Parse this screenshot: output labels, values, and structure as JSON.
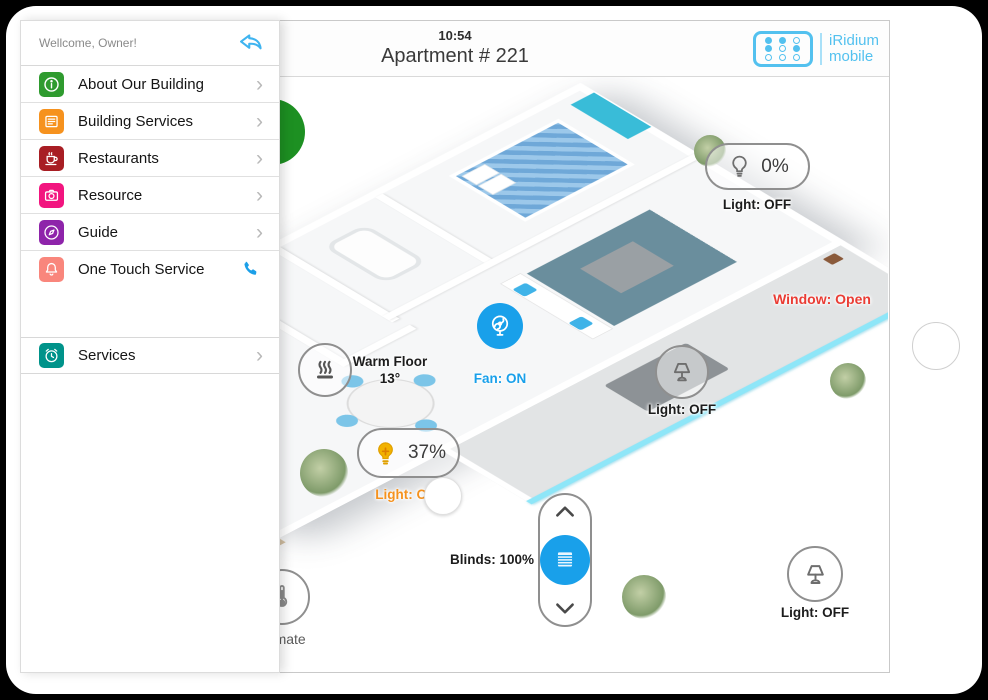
{
  "app": {
    "time": "10:54",
    "title": "Apartment # 221"
  },
  "logo": {
    "line1": "iRidium",
    "line2": "mobile",
    "color": "#53c1ef",
    "icon": "dots-grid-icon"
  },
  "sidebar": {
    "greeting": "Wellcome, Owner!",
    "back_icon": "reply-arrow-icon",
    "items": [
      {
        "label": "About Our Building",
        "icon": "info-icon",
        "color": "#2f9b2f"
      },
      {
        "label": "Building Services",
        "icon": "form-list-icon",
        "color": "#f6921e"
      },
      {
        "label": "Restaurants",
        "icon": "coffee-cup-icon",
        "color": "#a81e24"
      },
      {
        "label": "Resource",
        "icon": "camera-icon",
        "color": "#f2157f"
      },
      {
        "label": "Guide",
        "icon": "compass-icon",
        "color": "#8e24aa"
      },
      {
        "label": "One Touch Service",
        "icon": "bell-icon",
        "color": "#f9867c",
        "trailing_icon": "phone-icon",
        "trailing_color": "#1b9fe8"
      }
    ],
    "services_item": {
      "label": "Services",
      "icon": "alarm-clock-icon",
      "color": "#00938a"
    }
  },
  "controls": {
    "maid": {
      "label": "MAID",
      "color": "#1d9022",
      "icon": "hand-icon"
    },
    "bedroom_light": {
      "value": "0%",
      "label": "Light: OFF",
      "icon": "bulb-icon"
    },
    "window": {
      "label": "Window: Open",
      "color": "#ea3c34"
    },
    "warm_floor": {
      "title": "Warm Floor",
      "value": "13°",
      "icon": "heat-waves-icon"
    },
    "fan": {
      "label": "Fan: ON",
      "color": "#19a0ea",
      "icon": "fan-icon"
    },
    "living_light": {
      "label": "Light: OFF",
      "icon": "table-lamp-icon"
    },
    "dining_light": {
      "value": "37%",
      "label": "Light: ON",
      "color": "#f5921e",
      "icon": "bulb-on-icon"
    },
    "blinds": {
      "label": "Blinds: 100%",
      "icon": "blinds-icon"
    },
    "terrace_light": {
      "label": "Light: OFF",
      "icon": "table-lamp-icon"
    },
    "climate": {
      "label": "Climate",
      "icon": "thermometer-icon"
    }
  }
}
